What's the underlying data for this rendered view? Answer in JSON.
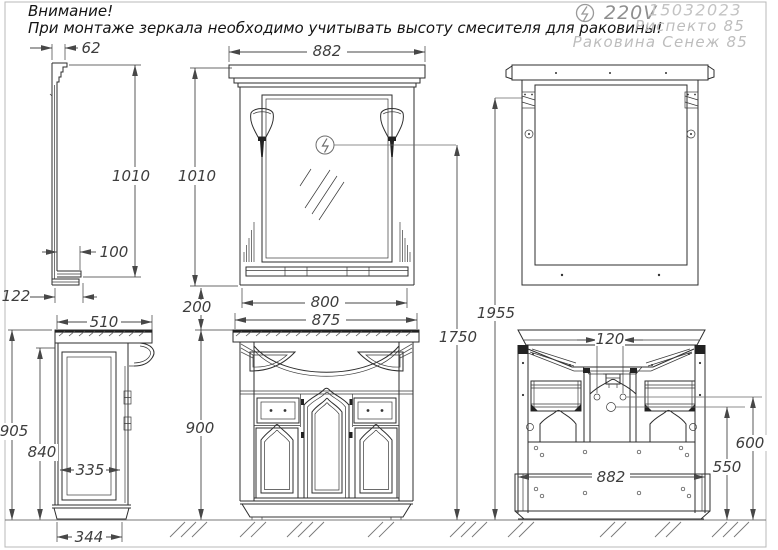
{
  "header": {
    "warning_line1": "Внимание!",
    "warning_line2": "При монтаже зеркала необходимо учитывать высоту смесителя для раковины!",
    "voltage": "220V",
    "date_code": "15032023",
    "model": "Риспекто 85",
    "sink_model": "Раковина Сенеж 85"
  },
  "icons": {
    "electric": "lightning-in-circle"
  },
  "colors": {
    "object_line": "#2e2e2e",
    "dimension_line": "#474747",
    "muted_title_text": "#bdbdbd",
    "voltage_text": "#8f8f8f",
    "warning_text": "#141414"
  },
  "dims": {
    "mirror_crown_depth": "62",
    "mirror_height_side": "1010",
    "mirror_shelf_depth": "100",
    "mirror_depth": "122",
    "mirror_width": "882",
    "mirror_height": "1010",
    "mirror_glass_width": "800",
    "mirror_gap": "200",
    "mirror_mount_height": "1955",
    "total_height": "1750",
    "countertop_width": "875",
    "cabinet_height": "900",
    "cabinet_depth": "510",
    "cabinet_side_height": "905",
    "side_panel_height": "840",
    "side_panel_width": "335",
    "base_depth": "344",
    "drain_offset": "120",
    "cabinet_width": "882",
    "outlet_height": "600",
    "drain_height": "550"
  }
}
